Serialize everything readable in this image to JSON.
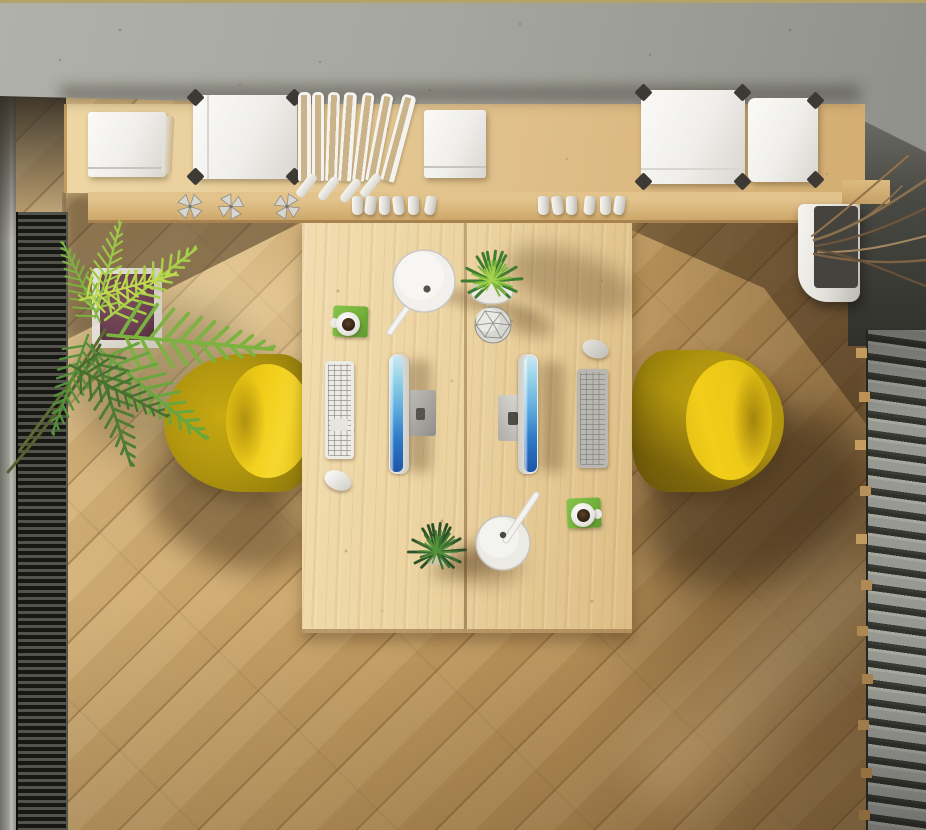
{
  "scene": {
    "type": "photograph",
    "view": "top-down",
    "title": "Top-down office workspace",
    "description": "Overhead view of a shared double workstation: a light pine desk with two flat monitors facing opposite sides, a white and a grey keyboard, two mice, two articulated white desk lamps, two potted plants, a faceted decor sphere and two coffee mugs on green coasters. Two yellow shell chairs flank the desk. Above, a wall shelf in front of a concrete wall holds white storage boxes with dark corner protectors, a row of books, paper cups and metallic pinwheels. A palm plant and a dark floor vent run along the left edge, a grey louvred slat bench and a white planter with dry branches along the right edge, all over diagonally laid oak flooring."
  },
  "objects": {
    "concrete_wall": {
      "label": "Concrete wall"
    },
    "wall_shelf": {
      "label": "Wooden wall shelf"
    },
    "shelf_ledge": {
      "label": "Lower shelf ledge"
    },
    "box_stack_left": {
      "label": "White box stack"
    },
    "open_storage_box": {
      "label": "White storage box with corner protectors"
    },
    "books_row": {
      "label": "Row of books"
    },
    "box_stack_small": {
      "label": "Small white box stack"
    },
    "storage_box_a": {
      "label": "Storage box with dark corners"
    },
    "storage_box_b": {
      "label": "Storage box with dark corners"
    },
    "pinwheels": {
      "label": "Metallic pinwheel decorations"
    },
    "paper_cups": {
      "label": "Paper cups"
    },
    "desk": {
      "label": "Double workstation desk, light pine"
    },
    "desk_seam": {
      "label": "Desk centre seam"
    },
    "monitor_left": {
      "label": "Monitor of left workstation"
    },
    "monitor_right": {
      "label": "Monitor of right workstation"
    },
    "stand_left": {
      "label": "Monitor stand"
    },
    "stand_right": {
      "label": "Monitor stand"
    },
    "keyboard_left": {
      "label": "White keyboard"
    },
    "keyboard_right": {
      "label": "Grey keyboard"
    },
    "mouse_left": {
      "label": "White mouse"
    },
    "mouse_right": {
      "label": "Grey mouse"
    },
    "lamp_top": {
      "label": "White desk lamp"
    },
    "lamp_bottom": {
      "label": "White desk lamp"
    },
    "plant_top": {
      "label": "Potted green plant"
    },
    "plant_bottom": {
      "label": "Potted dark green plant"
    },
    "geo_ball": {
      "label": "Faceted decor sphere"
    },
    "coaster_top": {
      "label": "Green coaster"
    },
    "coaster_bottom": {
      "label": "Green coaster"
    },
    "mug_top": {
      "label": "Coffee mug"
    },
    "mug_bottom": {
      "label": "Coffee mug"
    },
    "chair_left": {
      "label": "Yellow shell chair, left"
    },
    "chair_right": {
      "label": "Yellow shell chair, right"
    },
    "palm_plant": {
      "label": "Palm plant"
    },
    "palm_planter": {
      "label": "Palm planter with moss"
    },
    "floor_vent": {
      "label": "Dark louvred floor vent"
    },
    "wall_strip": {
      "label": "Grey wall strip"
    },
    "slat_bench": {
      "label": "Grey louvred slats"
    },
    "branch_planter": {
      "label": "White planter"
    },
    "branches": {
      "label": "Dry decorative branches"
    },
    "floor": {
      "label": "Diagonal oak flooring"
    }
  },
  "colors": {
    "floor_base": "#c9a265",
    "floor_light": "#dfc08b",
    "floor_dark": "#96744a",
    "desk_wood": "#ecd3a0",
    "desk_wood_dark": "#dcbd85",
    "shelf_wood": "#e0c08a",
    "shelf_wood_dark": "#cfa96e",
    "concrete": "#a6a79f",
    "concrete_dark": "#8f908a",
    "top_line": "#b3a36b",
    "vent_dark": "#1f1f1c",
    "vent_fin": "#53534c",
    "slat_face": "#979892",
    "slat_gap": "#31312c",
    "chair_shell": "#b0940e",
    "chair_seat": "#f2ce1a",
    "screen_blue_top": "#c9e7f3",
    "screen_blue_mid": "#5aa7dc",
    "screen_blue_deep": "#1d55a6",
    "coaster_green": "#74b23c",
    "coffee": "#2f2014",
    "leaf_light": "#a8cf4a",
    "leaf_mid": "#7cb23f",
    "leaf_dark": "#4e7c35",
    "plant_dark": "#2c5526",
    "branch": "#8a6f4e",
    "moss": "#6b4050",
    "white": "#f1f0ec"
  }
}
